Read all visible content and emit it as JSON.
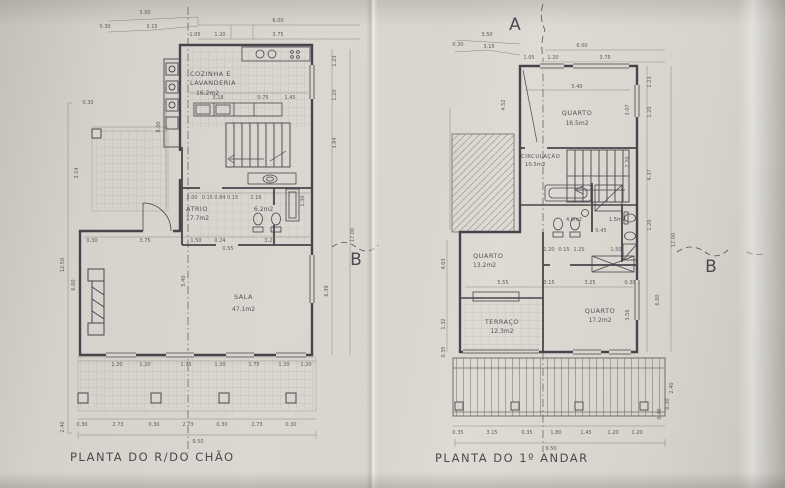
{
  "colors": {
    "paper": "#d8d5ce",
    "ink": "#47454c",
    "dim_line": "#8a867e",
    "tile": "#a39f96"
  },
  "ground": {
    "title": "PLANTA DO R/DO CHÃO",
    "marker_b": "B",
    "rooms": {
      "kitchen": {
        "line1": "COZINHA E",
        "line2": "LAVANDERIA",
        "area": "16.2m2"
      },
      "atrio": {
        "name": "ATRIO",
        "area": "17.7m2"
      },
      "bath": {
        "area": "6.2m2"
      },
      "sala": {
        "name": "SALA",
        "area": "47.1m2"
      }
    },
    "dims": {
      "top": [
        "3.50",
        "0.30",
        "3.15",
        "6.00",
        "1.05",
        "1.20",
        "3.75"
      ],
      "kitchen_row": [
        "3.18",
        "0.75",
        "1.45"
      ],
      "atrio_row": [
        "2.00",
        "0.15 0.84 0.15",
        "2.16",
        "1.36"
      ],
      "mid_row": [
        "0.30",
        "3.75",
        "1.50",
        "0.24",
        "0.55",
        "3.25"
      ],
      "window_row": [
        "1.20",
        "1.20",
        "1.75",
        "1.20",
        "1.75",
        "1.20",
        "1.20"
      ],
      "col_row": [
        "0.30",
        "2.73",
        "0.30",
        "2.73",
        "0.30",
        "2.73",
        "0.30"
      ],
      "total": "9.50",
      "left": [
        "0.30",
        "3.14",
        "8.00",
        "12.50",
        "6.00",
        "2.40"
      ],
      "right": [
        "1.23",
        "1.20",
        "3.84",
        "17.00",
        "6.39"
      ],
      "center": "5.40"
    }
  },
  "first": {
    "title": "PLANTA DO 1º ANDAR",
    "marker_a": "A",
    "marker_b": "B",
    "rooms": {
      "quarto1": {
        "name": "QUARTO",
        "area": "16.5m2"
      },
      "circ": {
        "name": "CIRCULAÇÃO",
        "area": "10.5m2"
      },
      "bath1": {
        "area": "4.0m2"
      },
      "bath2": {
        "area": "1.5m2"
      },
      "quarto2": {
        "name": "QUARTO",
        "area": "13.2m2"
      },
      "quarto3": {
        "name": "QUARTO",
        "area": "17.2m2"
      },
      "terraco": {
        "name": "TERRAÇO",
        "area": "12.3m2"
      }
    },
    "dims": {
      "top": [
        "3.50",
        "0.30",
        "3.15",
        "6.00",
        "1.05",
        "1.20",
        "3.75"
      ],
      "quarto1_w": "5.40",
      "bath_row": [
        "1.20",
        "0.15",
        "1.25",
        "0.45",
        "1.50"
      ],
      "mid_row": [
        "5.55",
        "0.15",
        "3.25",
        "0.30"
      ],
      "bottom_row": [
        "0.35",
        "3.15",
        "0.35",
        "1.80",
        "1.45",
        "1.20",
        "1.20"
      ],
      "total": "9.50",
      "left": [
        "4.52",
        "4.03",
        "1.32",
        "0.35"
      ],
      "right": [
        "1.23",
        "1.20",
        "4.37",
        "1.20",
        "3.07",
        "2.20",
        "3.56",
        "6.00",
        "17.00",
        "2.40",
        "0.30",
        "0.30"
      ]
    }
  }
}
